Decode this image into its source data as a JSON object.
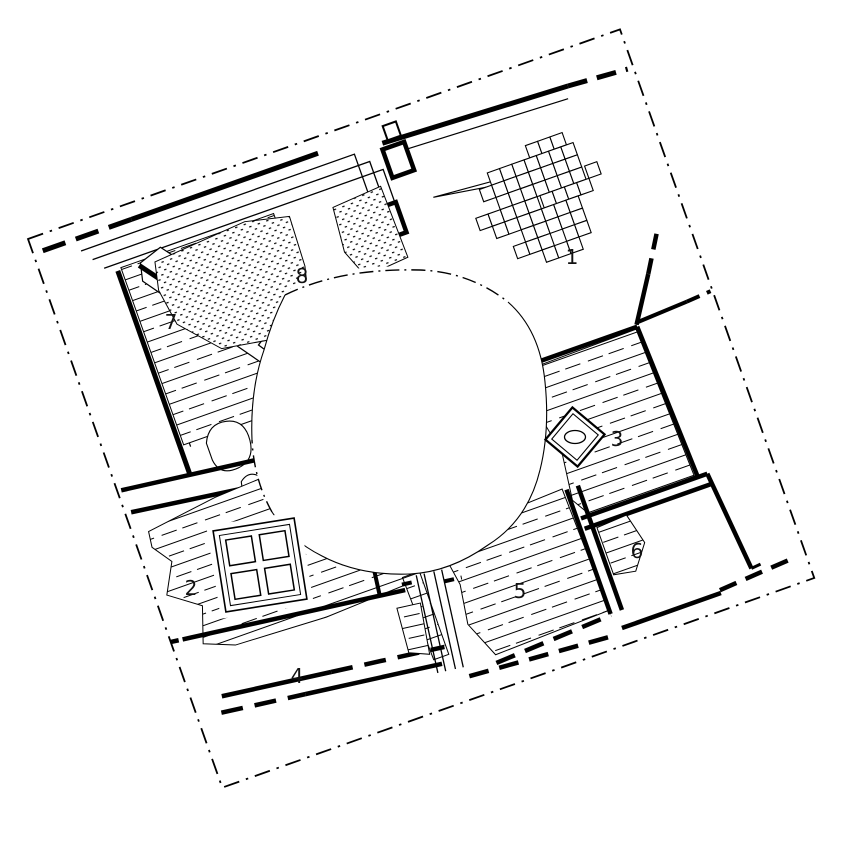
{
  "plan": {
    "title": "excavation-plan",
    "background": "#ffffff",
    "ink": "#000000",
    "rooms": [
      {
        "label": "1"
      },
      {
        "label": "2"
      },
      {
        "label": "3"
      },
      {
        "label": "4"
      },
      {
        "label": "5"
      },
      {
        "label": "6"
      },
      {
        "label": "7"
      },
      {
        "label": "8"
      }
    ]
  }
}
